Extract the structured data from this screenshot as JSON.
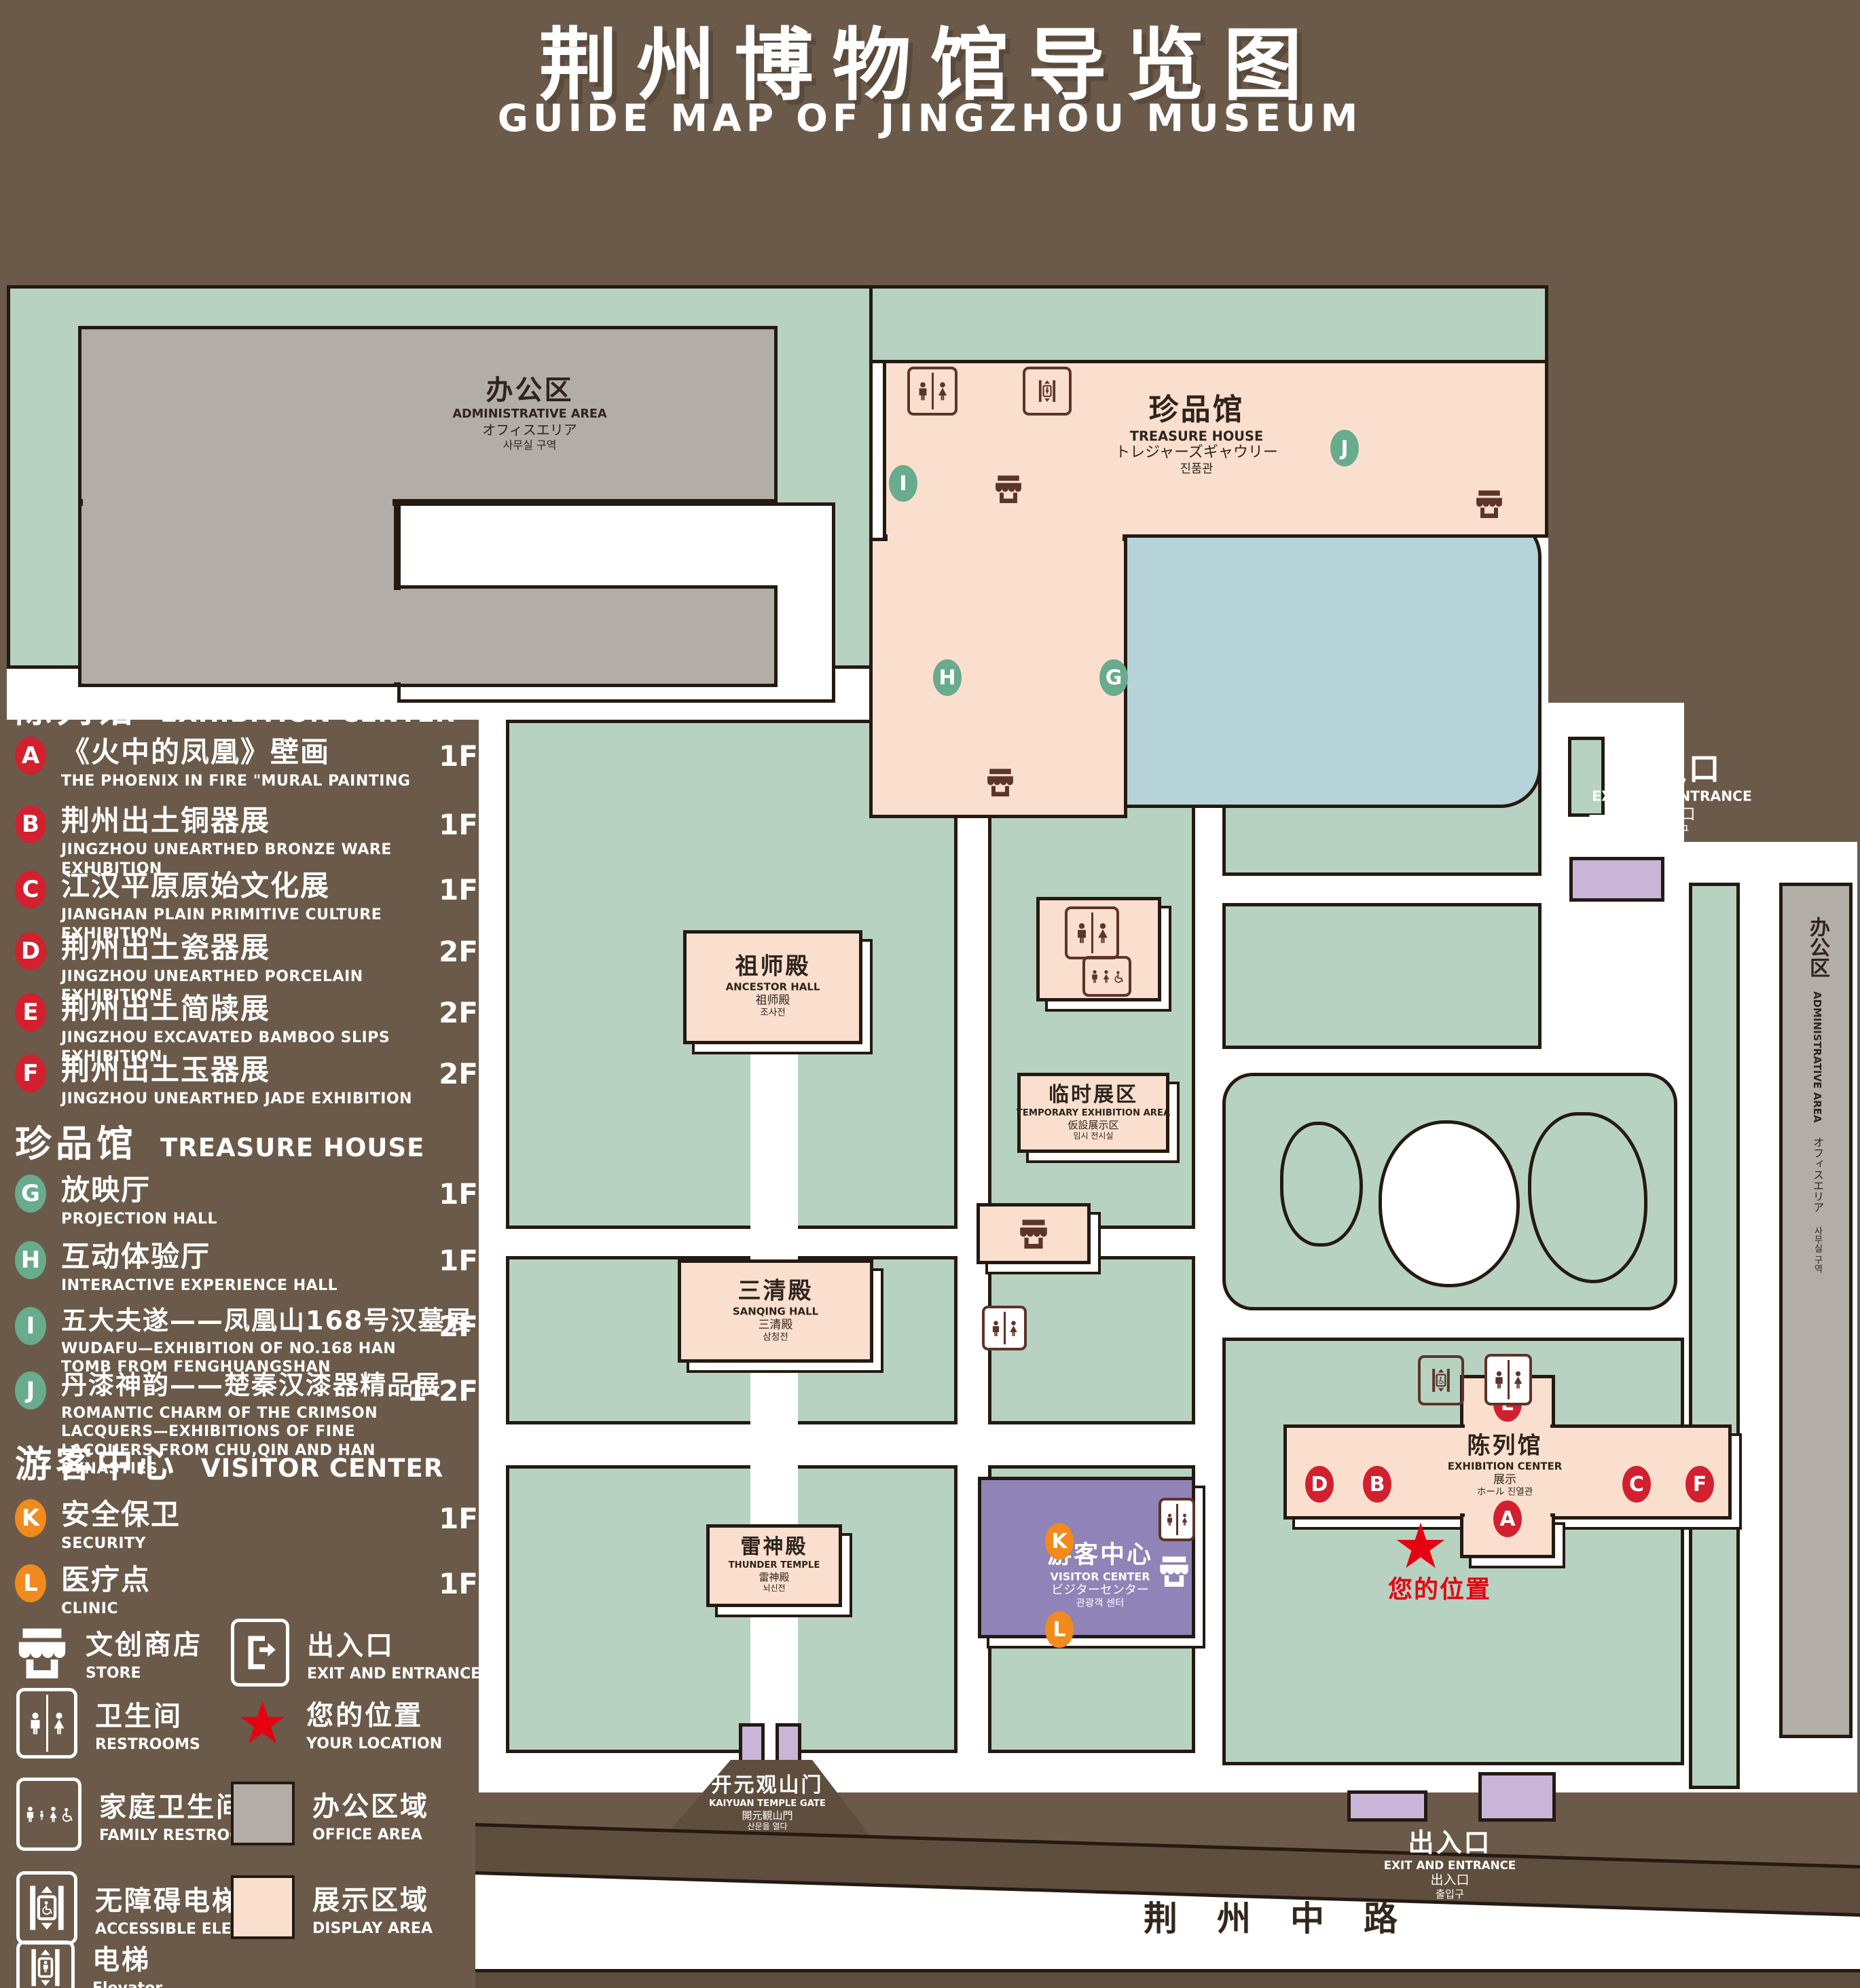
{
  "title": {
    "zh": "荆州博物馆导览图",
    "en": "GUIDE MAP OF JINGZHOU MUSEUM"
  },
  "legend": {
    "sections": [
      {
        "zh": "陈列馆",
        "en": "EXHIBITION CENTER",
        "items": [
          {
            "letter": "A",
            "zh": "《火中的凤凰》壁画",
            "en": "THE PHOENIX IN FIRE \"MURAL PAINTING",
            "floor": "1F"
          },
          {
            "letter": "B",
            "zh": "荆州出土铜器展",
            "en": "JINGZHOU UNEARTHED BRONZE WARE EXHIBITION",
            "floor": "1F"
          },
          {
            "letter": "C",
            "zh": "江汉平原原始文化展",
            "en": "JIANGHAN PLAIN PRIMITIVE CULTURE EXHIBITION",
            "floor": "1F"
          },
          {
            "letter": "D",
            "zh": "荆州出土瓷器展",
            "en": "JINGZHOU UNEARTHED PORCELAIN EXHIBITIONE",
            "floor": "2F"
          },
          {
            "letter": "E",
            "zh": "荆州出土简牍展",
            "en": "JINGZHOU EXCAVATED BAMBOO SLIPS EXHIBITION",
            "floor": "2F"
          },
          {
            "letter": "F",
            "zh": "荆州出土玉器展",
            "en": "JINGZHOU UNEARTHED JADE EXHIBITION",
            "floor": "2F"
          }
        ]
      },
      {
        "zh": "珍品馆",
        "en": "TREASURE HOUSE",
        "items": [
          {
            "letter": "G",
            "zh": "放映厅",
            "en": "PROJECTION HALL",
            "floor": "1F"
          },
          {
            "letter": "H",
            "zh": "互动体验厅",
            "en": "INTERACTIVE EXPERIENCE HALL",
            "floor": "1F"
          },
          {
            "letter": "I",
            "zh": "五大夫遂——凤凰山168号汉墓展",
            "en": "WUDAFU—EXHIBITION OF NO.168 HAN TOMB FROM FENGHUANGSHAN",
            "floor": "2F"
          },
          {
            "letter": "J",
            "zh": "丹漆神韵——楚秦汉漆器精品展",
            "en": "ROMANTIC CHARM OF THE CRIMSON LACQUERS—EXHIBITIONS OF FINE LACQUERS FROM CHU,QIN AND HAN DYNASTIES",
            "floor": "1-2F"
          }
        ]
      },
      {
        "zh": "游客中心",
        "en": "VISITOR CENTER",
        "items": [
          {
            "letter": "K",
            "zh": "安全保卫",
            "en": "SECURITY",
            "floor": "1F"
          },
          {
            "letter": "L",
            "zh": "医疗点",
            "en": "CLINIC",
            "floor": "1F"
          }
        ]
      }
    ],
    "symbols": [
      {
        "icon": "store-icon",
        "zh": "文创商店",
        "en": "STORE"
      },
      {
        "icon": "exit-icon",
        "zh": "出入口",
        "en": "EXIT AND ENTRANCE"
      },
      {
        "icon": "restrooms-icon",
        "zh": "卫生间",
        "en": "RESTROOMS"
      },
      {
        "icon": "your-location-star-icon",
        "zh": "您的位置",
        "en": "YOUR LOCATION",
        "glyph": "★"
      },
      {
        "icon": "family-restrooms-icon",
        "zh": "家庭卫生间",
        "en": "FAMILY RESTROOMS"
      },
      {
        "icon": "office-area-swatch",
        "zh": "办公区域",
        "en": "OFFICE AREA"
      },
      {
        "icon": "accessible-elevator-icon",
        "zh": "无障碍电梯",
        "en": "ACCESSIBLE ELEVATOR"
      },
      {
        "icon": "display-area-swatch",
        "zh": "展示区域",
        "en": "DISPLAY AREA"
      },
      {
        "icon": "elevator-icon",
        "zh": "电梯",
        "en": "Elevator"
      }
    ]
  },
  "map": {
    "admin_area": {
      "zh": "办公区",
      "en": "ADMINISTRATIVE AREA",
      "ja": "オフィスエリア",
      "ko": "사무실 구역"
    },
    "treasure_house": {
      "zh": "珍品馆",
      "en": "TREASURE HOUSE",
      "ja": "トレジャーズギャウリー",
      "ko": "진품관"
    },
    "ancestor_hall": {
      "zh": "祖师殿",
      "en": "ANCESTOR HALL",
      "ja": "祖师殿",
      "ko": "조사전"
    },
    "sanqing_hall": {
      "zh": "三清殿",
      "en": "SANQING HALL",
      "ja": "三清殿",
      "ko": "삼청전"
    },
    "temporary_area": {
      "zh": "临时展区",
      "en": "TEMPORARY EXHIBITION AREA",
      "ja": "仮設展示区",
      "ko": "임시 전시실"
    },
    "thunder_temple": {
      "zh": "雷神殿",
      "en": "THUNDER TEMPLE",
      "ja": "雷神殿",
      "ko": "뇌신전"
    },
    "visitor_center": {
      "zh": "游客中心",
      "en": "VISITOR CENTER",
      "ja": "ビジターセンター",
      "ko": "관광객 센터"
    },
    "exhibition_center": {
      "zh": "陈列馆",
      "en": "EXHIBITION CENTER",
      "ja": "展示",
      "ko": "ホール 진열관"
    },
    "kaiyuan_gate": {
      "zh": "开元观山门",
      "en": "KAIYUAN TEMPLE GATE",
      "ja": "開元観山門",
      "ko": "산문을 열다"
    },
    "exit_right": {
      "zh": "出入口",
      "en": "EXIT AND ENTRANCE",
      "zh2": "出入口",
      "ko": "출입구"
    },
    "exit_bottom": {
      "zh": "出入口",
      "en": "EXIT AND ENTRANCE",
      "zh2": "出入口",
      "ko": "출입구"
    },
    "your_location": "您的位置",
    "star": "★",
    "road": "荆州中路"
  },
  "colors": {
    "background_brown": "#6b5a49",
    "campus_green": "#b8d2c1",
    "display_pink": "#fadfce",
    "office_gray": "#b2ada6",
    "visitor_purple": "#9083b7",
    "gate_lavender": "#c8b5d8",
    "lake_blue": "#b7d3da",
    "badge_red": "#d2202f",
    "badge_green": "#68ab8d",
    "badge_orange": "#f28a1d",
    "icon_brown": "#5d342a",
    "location_red": "#e60012"
  }
}
